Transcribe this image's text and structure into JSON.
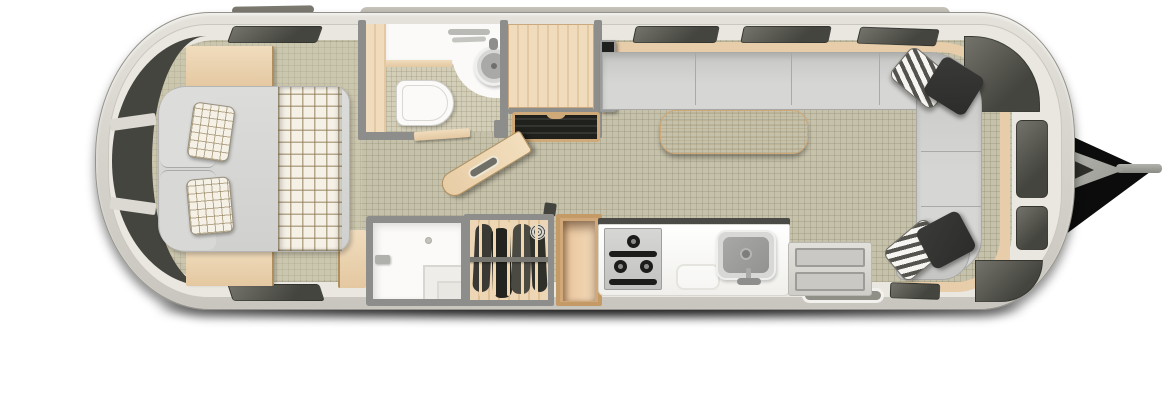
{
  "title": "Travel trailer floor plan — top-down view",
  "scene": {
    "type": "travel-trailer-floor-plan",
    "areas": {
      "bedroom": [
        "double-bed",
        "plaid-pillows",
        "plaid-throw",
        "nightstand-top",
        "nightstand-bottom",
        "foot-cabinet"
      ],
      "bathroom": [
        "vanity-counter",
        "round-sink",
        "faucet",
        "toilet",
        "toiletries",
        "wall-shelf"
      ],
      "entry": [
        "wardrobe",
        "entry-door-open",
        "entry-step",
        "tv-panel",
        "door-latch"
      ],
      "lounge": [
        "l-shaped-sofa",
        "dinette-table",
        "striped-pillows",
        "black-pillows",
        "wood-trim-band"
      ],
      "kitchen": [
        "three-burner-stove",
        "kitchen-sink",
        "faucet",
        "cutting-board",
        "counter-extension",
        "backsplash"
      ],
      "bottom-row": [
        "shower",
        "hanging-closet",
        "clothes-on-hangers",
        "open-cabinet"
      ],
      "exterior": [
        "windows",
        "awning-roll",
        "roof-marker",
        "a-frame-hitch",
        "tongue-bar",
        "ground-shadow"
      ]
    }
  },
  "colors": {
    "page_bg": "#ffffff",
    "shell_light": "#e4e2da",
    "shell": "#d6d4cc",
    "shell_dark": "#c8c6be",
    "shell_outline": "#94928a",
    "inner_wall": "#e9e7df",
    "inner_wall_edge": "#c9c7be",
    "wall": "#8d8d8b",
    "floor": "#c5c1aa",
    "floor_line": "rgba(122,114,88,0.22)",
    "tile": "#d3ceb8",
    "window_dark": "#45453f",
    "window_light": "#73736b",
    "wood_light": "#f0dcbd",
    "wood": "#e4c8a1",
    "wood_dark": "#b08f5e",
    "wood_band": "#e7cda9",
    "mattress_light": "#dcdcda",
    "mattress": "#d0d0ce",
    "mattress_edge": "#b5b5b3",
    "plaid_bg": "#f5f1e6",
    "plaid_line": "rgba(139,120,82,0.6)",
    "sofa": "#c6c6c4",
    "sofa_light": "#d6d6d4",
    "sofa_edge": "#a9a9a7",
    "white_fixture": "#fbfaf8",
    "steel": "#a9a9a7",
    "steel_dark": "#8e8e8c",
    "appliance_dark": "#1c1c1a",
    "textile_dark": "#2c2c2a",
    "textile_stripe_dark": "#55534d",
    "textile_stripe_light": "#f6f5f2",
    "step_dark": "#20201c",
    "tv_black": "#1f1f1d",
    "hitch": "#a5a59f",
    "hitch_shadow": "#0c0c0c"
  }
}
